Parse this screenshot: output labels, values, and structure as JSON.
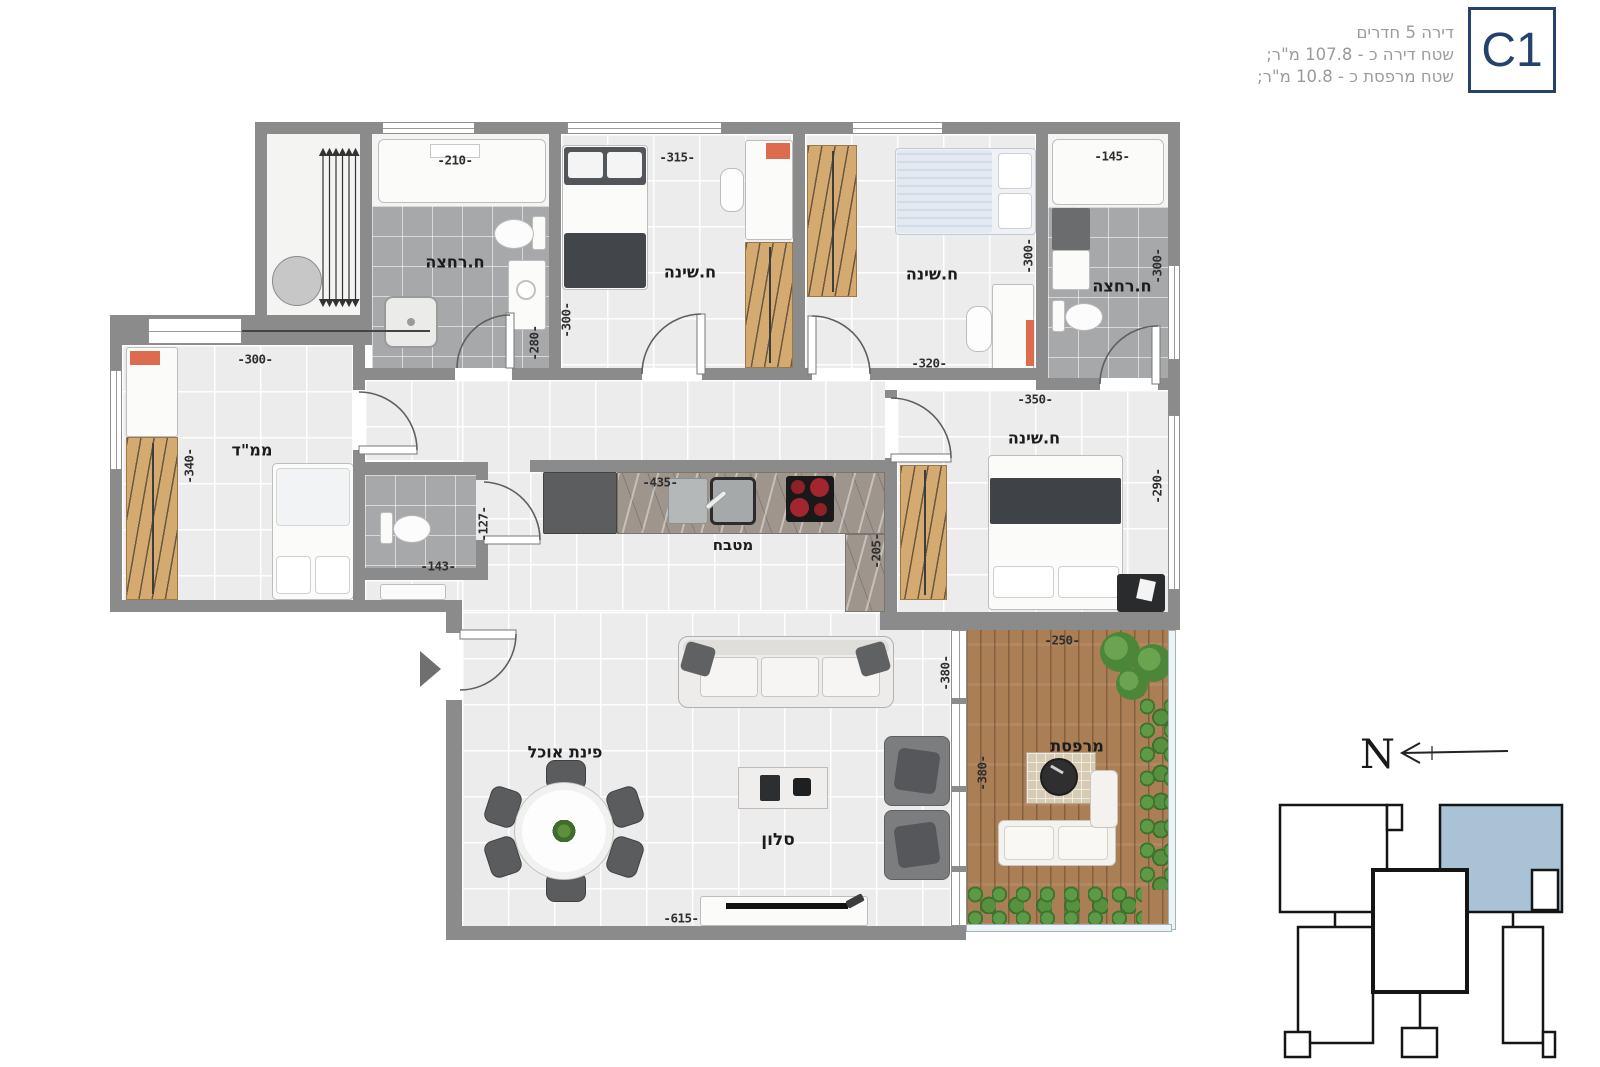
{
  "header": {
    "line1": "דירה 5 חדרים",
    "line2": "שטח דירה כ - 107.8 מ\"ר;",
    "line3": "שטח מרפסת כ - 10.8 מ\"ר;",
    "unit_label": "C1"
  },
  "compass": {
    "north_letter": "N"
  },
  "rooms": {
    "bath_top_left": {
      "label": "ח.רחצה"
    },
    "bedroom_top_left": {
      "label": "ח.שינה"
    },
    "bedroom_top_right": {
      "label": "ח.שינה"
    },
    "bath_top_right": {
      "label": "ח.רחצה"
    },
    "safe_room": {
      "label": "ממ\"ד"
    },
    "kitchen": {
      "label": "מטבח"
    },
    "bedroom_master": {
      "label": "ח.שינה"
    },
    "dining": {
      "label": "פינת אוכל"
    },
    "living": {
      "label": "סלון"
    },
    "balcony": {
      "label": "מרפסת"
    }
  },
  "dims": {
    "bath1_w": "-210-",
    "bath1_h": "-280-",
    "bed2_w": "-315-",
    "bed2_h": "-300-",
    "bed3_w": "-320-",
    "bed3_h": "-300-",
    "bath2_w": "-145-",
    "bath2_h": "-300-",
    "mamad_w": "-300-",
    "mamad_h": "-340-",
    "wc_w": "-143-",
    "wc_h": "-127-",
    "kitchen_w": "-435-",
    "kitchen_h": "-205-",
    "master_w": "-350-",
    "master_h": "-290-",
    "balcony_w": "-250-",
    "balcony_h": "-380-",
    "living_h": "-380-",
    "living_w": "-615-"
  },
  "colors": {
    "accent_navy": "#24426b",
    "keyplan_highlight": "#a9c2d6",
    "wall_gray": "#8b8b8b",
    "header_text": "#9b9b9b"
  }
}
